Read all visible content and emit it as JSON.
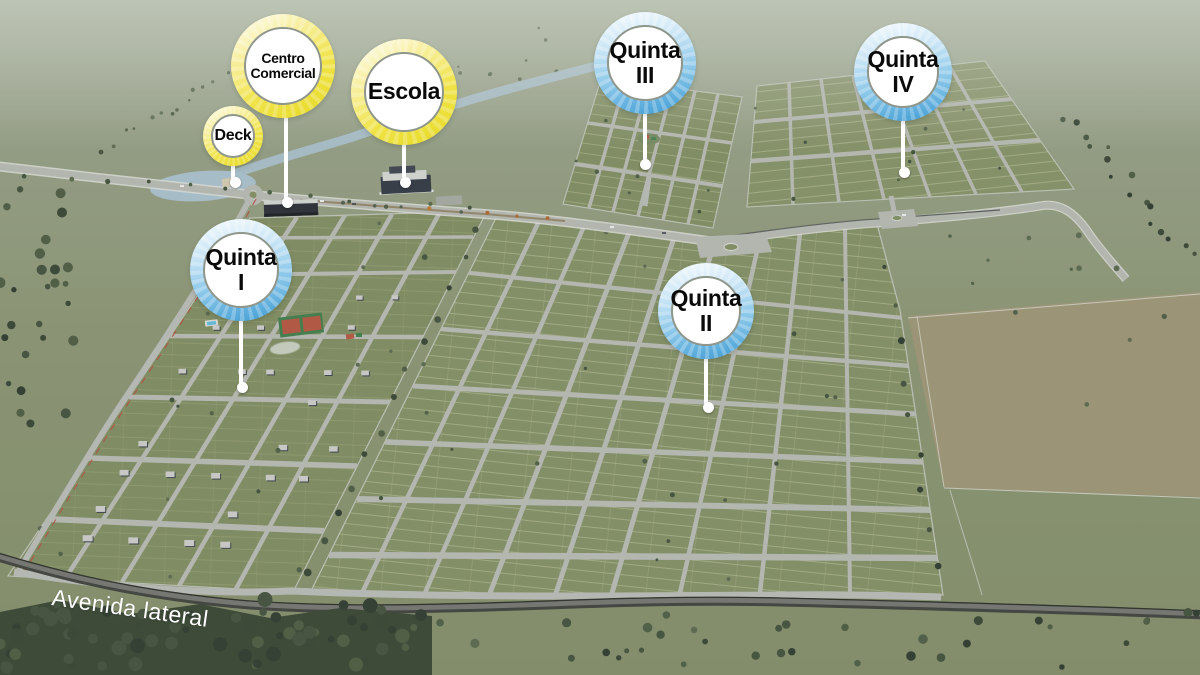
{
  "markers": [
    {
      "id": "centro-comercial",
      "line1": "Centro",
      "line2": "Comercial",
      "color": "yellow",
      "category": "amenity"
    },
    {
      "id": "escola",
      "line1": "Escola",
      "line2": "",
      "color": "yellow",
      "category": "amenity"
    },
    {
      "id": "deck",
      "line1": "Deck",
      "line2": "",
      "color": "yellow",
      "category": "amenity"
    },
    {
      "id": "quinta-i",
      "line1": "Quinta",
      "line2": "I",
      "color": "blue",
      "category": "phase"
    },
    {
      "id": "quinta-ii",
      "line1": "Quinta",
      "line2": "II",
      "color": "blue",
      "category": "phase"
    },
    {
      "id": "quinta-iii",
      "line1": "Quinta",
      "line2": "III",
      "color": "blue",
      "category": "phase"
    },
    {
      "id": "quinta-iv",
      "line1": "Quinta",
      "line2": "IV",
      "color": "blue",
      "category": "phase"
    }
  ],
  "road_label": "Avenida lateral",
  "palette": {
    "marker_yellow": "#ecdf33",
    "marker_blue": "#4aa2d7",
    "marker_face": "#ffffff",
    "marker_text": "#0a0a0a",
    "road_light": "#b2b4ae",
    "road_dark": "#3b3e39",
    "grass": "#7e8b60",
    "water": "#a4bcc7",
    "field_brown": "#9a9171",
    "road_label_color": "#ffffff"
  }
}
